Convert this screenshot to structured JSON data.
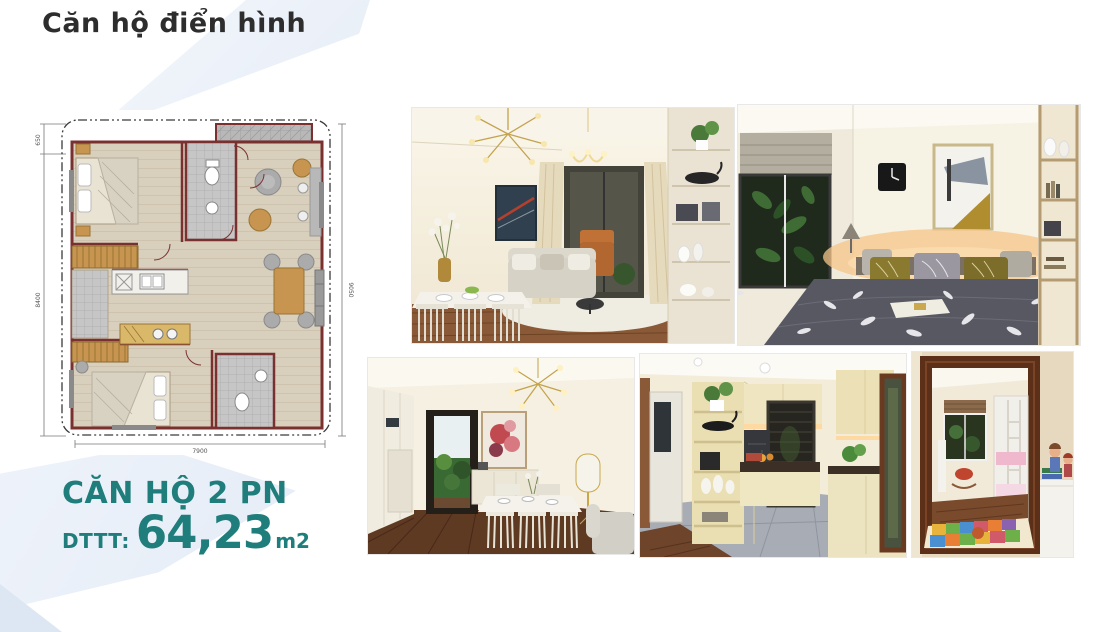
{
  "slide": {
    "title": "Căn hộ điển hình",
    "unit_name": "CĂN HỘ 2 PN",
    "area_label": "DTTT:",
    "area_value": "64,23",
    "area_unit": "m2"
  },
  "floor_plan": {
    "dims": {
      "top_left": "650",
      "left": "8400",
      "bottom": "7900",
      "right": "9050"
    }
  },
  "photos": [
    {
      "name": "living-dining-room"
    },
    {
      "name": "master-bedroom"
    },
    {
      "name": "dining-hallway"
    },
    {
      "name": "kitchen"
    },
    {
      "name": "kids-room-through-door"
    }
  ],
  "colors": {
    "accent_teal": "#1f7d7b",
    "background_shape": "#e9eff8",
    "wall_maroon": "#7b3030",
    "wood_floor": "#8a5a38"
  }
}
